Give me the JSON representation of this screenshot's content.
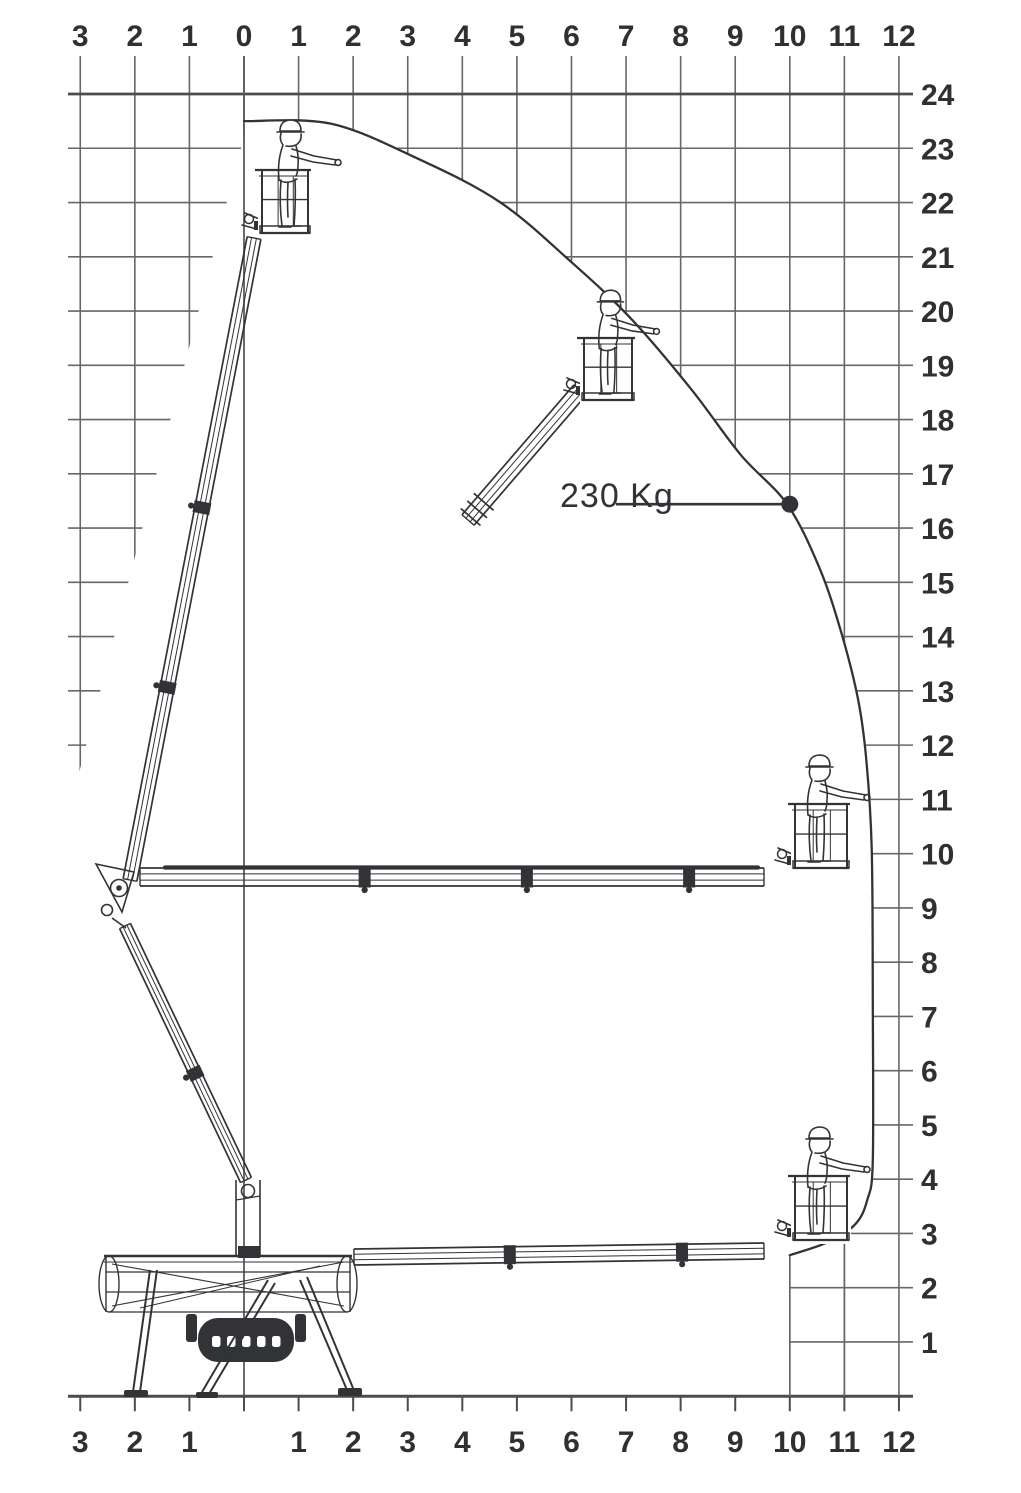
{
  "figure": {
    "description": "Working envelope / outreach diagram of an articulated telescopic spider aerial work platform, shown in four poses with operator in basket",
    "units": "m",
    "colors": {
      "background": "#ffffff",
      "grid": "#66676a",
      "axis": "#4b4c4e",
      "ink": "#323336",
      "text": "#2f3032"
    },
    "machine": {
      "type": "spider lift with telescopic articulated boom and basket",
      "poses": [
        {
          "name": "max-height",
          "basket_x_m": 0.5,
          "basket_floor_height_m": 21.5
        },
        {
          "name": "intermediate-raised",
          "basket_x_m": 6.4,
          "basket_floor_height_m": 18.3
        },
        {
          "name": "max-outreach-high",
          "basket_x_m": 10.3,
          "basket_floor_height_m": 9.8
        },
        {
          "name": "max-outreach-low",
          "basket_x_m": 10.3,
          "basket_floor_height_m": 2.9
        },
        {
          "name": "base-on-outriggers",
          "basket_x_m": -0.3,
          "basket_floor_height_m": 0
        }
      ]
    }
  },
  "chart_data": {
    "type": "line",
    "title": "",
    "xlabel": "",
    "ylabel": "",
    "x_unit": "m",
    "y_unit": "m",
    "x_range": [
      -3,
      12
    ],
    "y_range": [
      0,
      24
    ],
    "grid": true,
    "envelope": {
      "name": "working envelope boundary",
      "points": [
        [
          0,
          23.5
        ],
        [
          1.6,
          23.45
        ],
        [
          3.2,
          22.8
        ],
        [
          4.7,
          22.0
        ],
        [
          6.0,
          20.9
        ],
        [
          7.1,
          19.85
        ],
        [
          8.2,
          18.55
        ],
        [
          9.1,
          17.35
        ],
        [
          9.95,
          16.44
        ],
        [
          10.55,
          15.25
        ],
        [
          10.95,
          14.05
        ],
        [
          11.25,
          12.85
        ],
        [
          11.4,
          11.75
        ],
        [
          11.5,
          10.1
        ],
        [
          11.52,
          7.3
        ],
        [
          11.52,
          4.35
        ],
        [
          11.42,
          3.62
        ],
        [
          11.2,
          3.17
        ],
        [
          10.7,
          2.84
        ],
        [
          10.0,
          2.6
        ]
      ]
    },
    "load_point": {
      "label": "230 Kg",
      "x": 10.0,
      "y": 16.44
    },
    "ticks": {
      "top": [
        {
          "m": -3,
          "label": "3"
        },
        {
          "m": -2,
          "label": "2"
        },
        {
          "m": -1,
          "label": "1"
        },
        {
          "m": 0,
          "label": "0"
        },
        {
          "m": 1,
          "label": "1"
        },
        {
          "m": 2,
          "label": "2"
        },
        {
          "m": 3,
          "label": "3"
        },
        {
          "m": 4,
          "label": "4"
        },
        {
          "m": 5,
          "label": "5"
        },
        {
          "m": 6,
          "label": "6"
        },
        {
          "m": 7,
          "label": "7"
        },
        {
          "m": 8,
          "label": "8"
        },
        {
          "m": 9,
          "label": "9"
        },
        {
          "m": 10,
          "label": "10"
        },
        {
          "m": 11,
          "label": "11"
        },
        {
          "m": 12,
          "label": "12"
        }
      ],
      "bottom": [
        {
          "m": -3,
          "label": "3"
        },
        {
          "m": -2,
          "label": "2"
        },
        {
          "m": -1,
          "label": "1"
        },
        {
          "m": 1,
          "label": "1"
        },
        {
          "m": 2,
          "label": "2"
        },
        {
          "m": 3,
          "label": "3"
        },
        {
          "m": 4,
          "label": "4"
        },
        {
          "m": 5,
          "label": "5"
        },
        {
          "m": 6,
          "label": "6"
        },
        {
          "m": 7,
          "label": "7"
        },
        {
          "m": 8,
          "label": "8"
        },
        {
          "m": 9,
          "label": "9"
        },
        {
          "m": 10,
          "label": "10"
        },
        {
          "m": 11,
          "label": "11"
        },
        {
          "m": 12,
          "label": "12"
        }
      ],
      "right": [
        {
          "h": 24,
          "label": "24"
        },
        {
          "h": 23,
          "label": "23"
        },
        {
          "h": 22,
          "label": "22"
        },
        {
          "h": 21,
          "label": "21"
        },
        {
          "h": 20,
          "label": "20"
        },
        {
          "h": 19,
          "label": "19"
        },
        {
          "h": 18,
          "label": "18"
        },
        {
          "h": 17,
          "label": "17"
        },
        {
          "h": 16,
          "label": "16"
        },
        {
          "h": 15,
          "label": "15"
        },
        {
          "h": 14,
          "label": "14"
        },
        {
          "h": 13,
          "label": "13"
        },
        {
          "h": 12,
          "label": "12"
        },
        {
          "h": 11,
          "label": "11"
        },
        {
          "h": 10,
          "label": "10"
        },
        {
          "h": 9,
          "label": "9"
        },
        {
          "h": 8,
          "label": "8"
        },
        {
          "h": 7,
          "label": "7"
        },
        {
          "h": 6,
          "label": "6"
        },
        {
          "h": 5,
          "label": "5"
        },
        {
          "h": 4,
          "label": "4"
        },
        {
          "h": 3,
          "label": "3"
        },
        {
          "h": 2,
          "label": "2"
        },
        {
          "h": 1,
          "label": "1"
        }
      ]
    }
  }
}
